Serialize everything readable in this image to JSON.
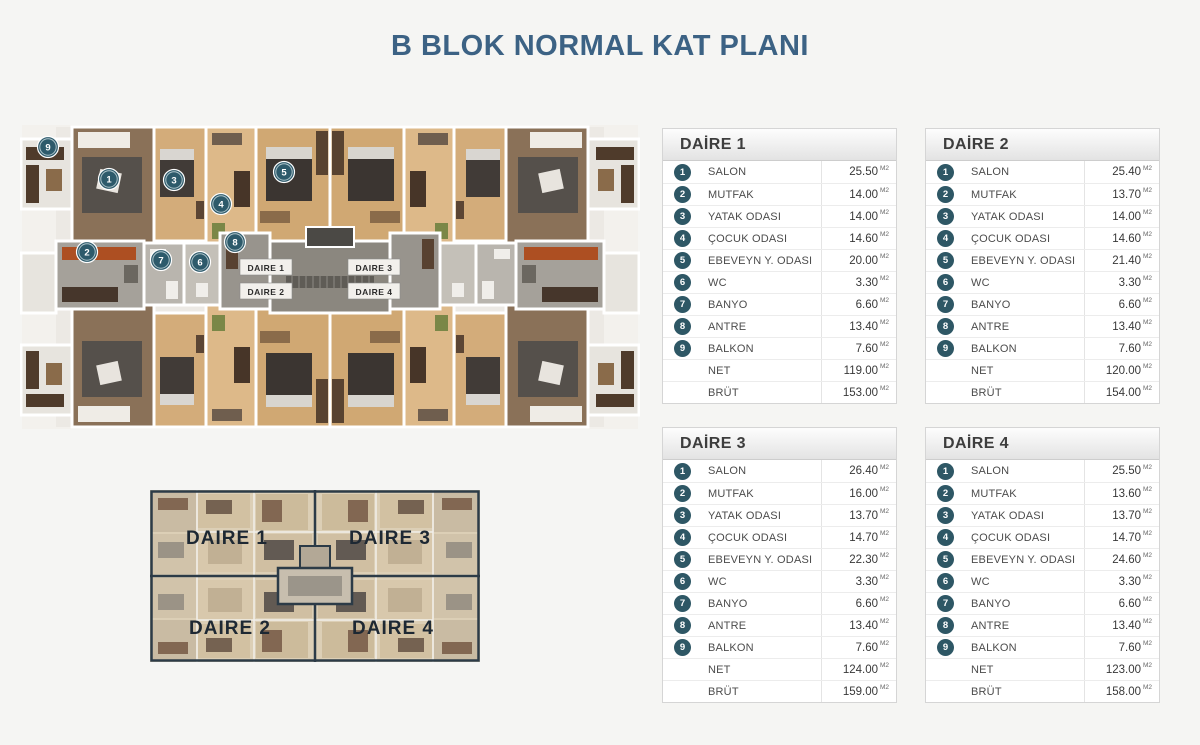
{
  "title": "B BLOK NORMAL KAT PLANI",
  "unit": "M2",
  "floorplan": {
    "markers": [
      {
        "n": "9",
        "x": 28,
        "y": 34
      },
      {
        "n": "1",
        "x": 89,
        "y": 66
      },
      {
        "n": "3",
        "x": 154,
        "y": 67
      },
      {
        "n": "4",
        "x": 201,
        "y": 91
      },
      {
        "n": "5",
        "x": 264,
        "y": 59
      },
      {
        "n": "2",
        "x": 67,
        "y": 139
      },
      {
        "n": "7",
        "x": 141,
        "y": 147
      },
      {
        "n": "6",
        "x": 180,
        "y": 149
      },
      {
        "n": "8",
        "x": 215,
        "y": 129
      }
    ],
    "center_labels": [
      {
        "text": "DAIRE 1",
        "x": 246,
        "y": 158
      },
      {
        "text": "DAIRE 3",
        "x": 354,
        "y": 158
      },
      {
        "text": "DAIRE 2",
        "x": 246,
        "y": 182
      },
      {
        "text": "DAIRE 4",
        "x": 354,
        "y": 182
      }
    ]
  },
  "mini_plan": {
    "labels": [
      {
        "text": "DAIRE 1",
        "x": 77,
        "y": 54
      },
      {
        "text": "DAIRE 3",
        "x": 240,
        "y": 54
      },
      {
        "text": "DAIRE 2",
        "x": 80,
        "y": 144
      },
      {
        "text": "DAIRE 4",
        "x": 243,
        "y": 144
      }
    ]
  },
  "apartments": [
    {
      "name": "DAİRE 1",
      "rows": [
        {
          "num": "1",
          "label": "SALON",
          "value": "25.50"
        },
        {
          "num": "2",
          "label": "MUTFAK",
          "value": "14.00"
        },
        {
          "num": "3",
          "label": "YATAK ODASI",
          "value": "14.00"
        },
        {
          "num": "4",
          "label": "ÇOCUK ODASI",
          "value": "14.60"
        },
        {
          "num": "5",
          "label": "EBEVEYN Y. ODASI",
          "value": "20.00"
        },
        {
          "num": "6",
          "label": "WC",
          "value": "3.30"
        },
        {
          "num": "7",
          "label": "BANYO",
          "value": "6.60"
        },
        {
          "num": "8",
          "label": "ANTRE",
          "value": "13.40"
        },
        {
          "num": "9",
          "label": "BALKON",
          "value": "7.60"
        },
        {
          "num": "",
          "label": "NET",
          "value": "119.00"
        },
        {
          "num": "",
          "label": "BRÜT",
          "value": "153.00"
        }
      ]
    },
    {
      "name": "DAİRE 2",
      "rows": [
        {
          "num": "1",
          "label": "SALON",
          "value": "25.40"
        },
        {
          "num": "2",
          "label": "MUTFAK",
          "value": "13.70"
        },
        {
          "num": "3",
          "label": "YATAK ODASI",
          "value": "14.00"
        },
        {
          "num": "4",
          "label": "ÇOCUK ODASI",
          "value": "14.60"
        },
        {
          "num": "5",
          "label": "EBEVEYN Y. ODASI",
          "value": "21.40"
        },
        {
          "num": "6",
          "label": "WC",
          "value": "3.30"
        },
        {
          "num": "7",
          "label": "BANYO",
          "value": "6.60"
        },
        {
          "num": "8",
          "label": "ANTRE",
          "value": "13.40"
        },
        {
          "num": "9",
          "label": "BALKON",
          "value": "7.60"
        },
        {
          "num": "",
          "label": "NET",
          "value": "120.00"
        },
        {
          "num": "",
          "label": "BRÜT",
          "value": "154.00"
        }
      ]
    },
    {
      "name": "DAİRE 3",
      "rows": [
        {
          "num": "1",
          "label": "SALON",
          "value": "26.40"
        },
        {
          "num": "2",
          "label": "MUTFAK",
          "value": "16.00"
        },
        {
          "num": "3",
          "label": "YATAK ODASI",
          "value": "13.70"
        },
        {
          "num": "4",
          "label": "ÇOCUK ODASI",
          "value": "14.70"
        },
        {
          "num": "5",
          "label": "EBEVEYN Y. ODASI",
          "value": "22.30"
        },
        {
          "num": "6",
          "label": "WC",
          "value": "3.30"
        },
        {
          "num": "7",
          "label": "BANYO",
          "value": "6.60"
        },
        {
          "num": "8",
          "label": "ANTRE",
          "value": "13.40"
        },
        {
          "num": "9",
          "label": "BALKON",
          "value": "7.60"
        },
        {
          "num": "",
          "label": "NET",
          "value": "124.00"
        },
        {
          "num": "",
          "label": "BRÜT",
          "value": "159.00"
        }
      ]
    },
    {
      "name": "DAİRE 4",
      "rows": [
        {
          "num": "1",
          "label": "SALON",
          "value": "25.50"
        },
        {
          "num": "2",
          "label": "MUTFAK",
          "value": "13.60"
        },
        {
          "num": "3",
          "label": "YATAK ODASI",
          "value": "13.70"
        },
        {
          "num": "4",
          "label": "ÇOCUK ODASI",
          "value": "14.70"
        },
        {
          "num": "5",
          "label": "EBEVEYN Y. ODASI",
          "value": "24.60"
        },
        {
          "num": "6",
          "label": "WC",
          "value": "3.30"
        },
        {
          "num": "7",
          "label": "BANYO",
          "value": "6.60"
        },
        {
          "num": "8",
          "label": "ANTRE",
          "value": "13.40"
        },
        {
          "num": "9",
          "label": "BALKON",
          "value": "7.60"
        },
        {
          "num": "",
          "label": "NET",
          "value": "123.00"
        },
        {
          "num": "",
          "label": "BRÜT",
          "value": "158.00"
        }
      ]
    }
  ]
}
